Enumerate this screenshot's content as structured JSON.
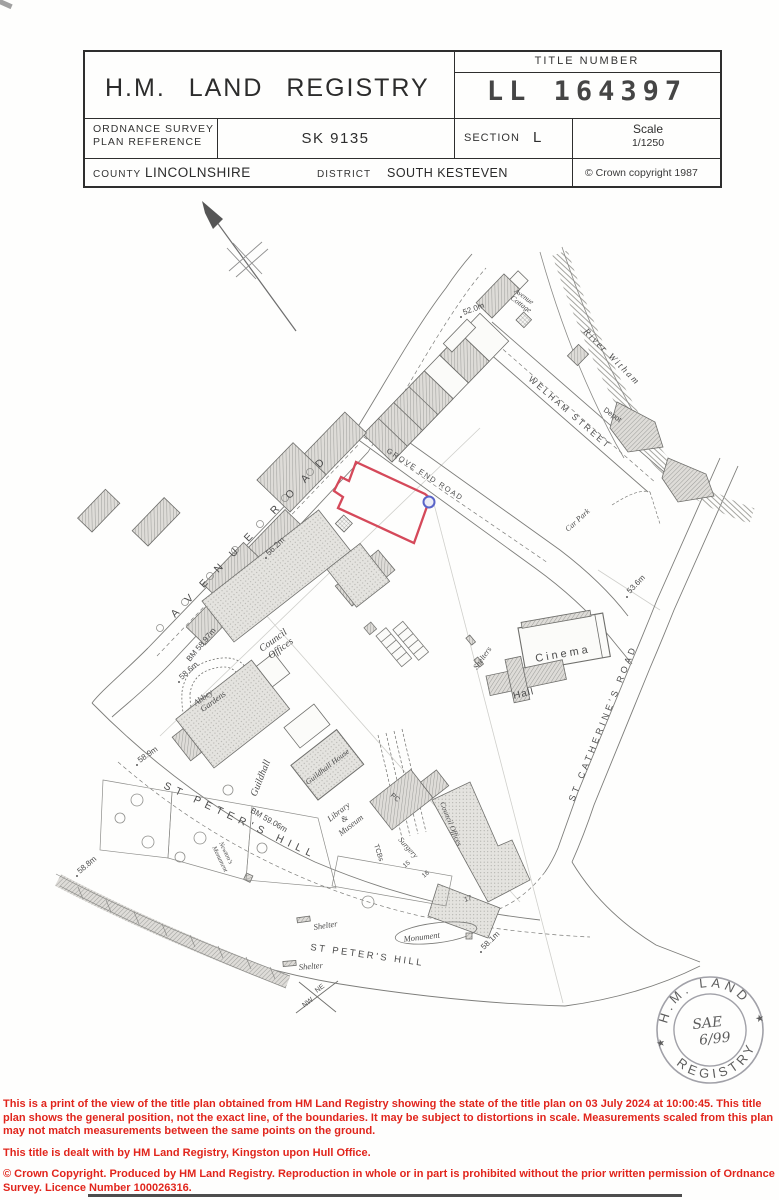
{
  "header": {
    "org": "H.M. LAND REGISTRY",
    "title_number_label": "TITLE NUMBER",
    "title_number": "LL 164397",
    "os_ref_label_l1": "ORDNANCE SURVEY",
    "os_ref_label_l2": "PLAN REFERENCE",
    "os_ref": "SK 9135",
    "section_label": "SECTION",
    "section": "L",
    "scale_label": "Scale",
    "scale": "1/1250",
    "county_label": "COUNTY",
    "county": "LINCOLNSHIRE",
    "district_label": "DISTRICT",
    "district": "SOUTH KESTEVEN",
    "copyright": "© Crown copyright  1987"
  },
  "map": {
    "streets": {
      "avenue_road": "AVENUE ROAD",
      "grove_end_road": "GROVE END ROAD",
      "welham_street": "WELHAM STREET",
      "st_catherines_road": "ST CATHERINE'S ROAD",
      "st_peters_hill_upper": "ST PETER'S HILL",
      "st_peters_hill_lower": "ST PETER'S HILL",
      "river_witham": "River Witham"
    },
    "places": {
      "avenue_cottage_l1": "Avenue",
      "avenue_cottage_l2": "Cottage",
      "depot": "Depot",
      "car_park": "Car Park",
      "cinema": "Cinema",
      "hall": "Hall",
      "shelters": "Shelters",
      "council_offices_l1": "Council",
      "council_offices_l2": "Offices",
      "abbey_gardens_l1": "Abbey",
      "abbey_gardens_l2": "Gardens",
      "guildhall": "Guildhall",
      "guildhall_house": "Guildhall House",
      "library_l1": "Library",
      "library_l2": "&",
      "library_l3": "Museum",
      "newtons_monument_l1": "Newton's",
      "newtons_monument_l2": "Monument",
      "surgery": "Surgery",
      "council_offices_right": "Council Offices",
      "monument": "Monument",
      "shelter_upper": "Shelter",
      "shelter_lower": "Shelter",
      "tcbs": "TCBs",
      "pc": "PC"
    },
    "levels": {
      "spot_52_0": "52.0m",
      "spot_56_2": "56.2m",
      "bm_58_97": "BM 58.97m",
      "spot_58_6": "58.6m",
      "spot_58_9": "58.9m",
      "spot_58_8": "58.8m",
      "bm_59_06": "BM 59.06m",
      "spot_58_1": "58.1m",
      "spot_53_6": "53.6m"
    },
    "house_numbers": {
      "n15": "15",
      "n16": "16",
      "n17": "17"
    },
    "compass": {
      "ne": "NE",
      "nw": "NW"
    },
    "boundary_color": "#d5495a",
    "marker_color": "#5a64c8"
  },
  "stamp": {
    "arc_top": "H.M. LAND",
    "arc_bottom": "REGISTRY",
    "star": "★",
    "hand_l1": "SAE",
    "hand_l2": "6/99"
  },
  "footer": {
    "p1": "This is a print of the view of the title plan obtained from HM Land Registry showing the state of the title plan on 03 July 2024 at 10:00:45. This title plan shows the general position, not the exact line, of the boundaries. It may be subject to distortions in scale. Measurements scaled from this plan may not match measurements between the same points on the ground.",
    "p2": "This title is dealt with by HM Land Registry, Kingston upon Hull Office.",
    "p3": "© Crown Copyright. Produced by HM Land Registry.  Reproduction in whole or in part is prohibited without the prior written permission of Ordnance Survey. Licence Number 100026316.",
    "color": "#e1251c"
  }
}
